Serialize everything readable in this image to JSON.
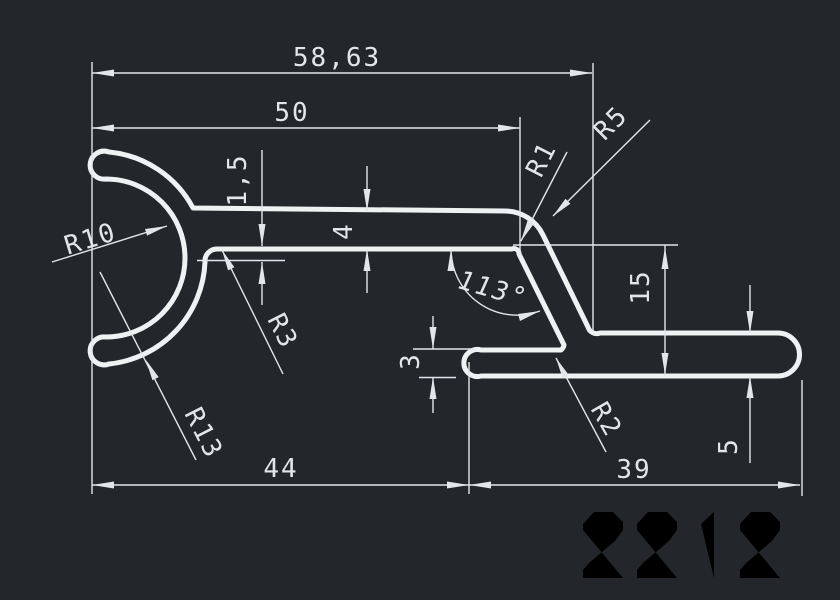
{
  "canvas": {
    "background": "#23272c",
    "profile_line_color": "#eff1f2",
    "dimension_color": "#e3e6e9",
    "part_number_color": "#d7dadd"
  },
  "part": {
    "number": "2212"
  },
  "dims": {
    "overall_width": "58,63",
    "upper_width": "50",
    "wall_gap": "1,5",
    "arm_height": "4",
    "angle": "113°",
    "right_height": "15",
    "lip_thickness": "3",
    "base_left_width": "44",
    "base_right_width": "39",
    "end_height": "5",
    "r_inner": "R10",
    "r_outer": "R13",
    "r_junction": "R3",
    "r_corner": "R1",
    "r_bend": "R5",
    "r_foot": "R2"
  }
}
